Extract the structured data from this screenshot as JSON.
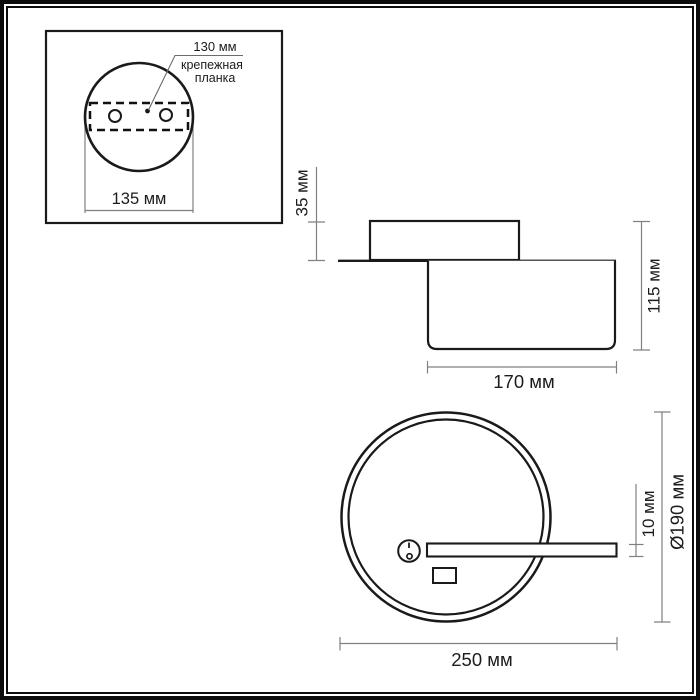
{
  "diagram": {
    "title": "luminaire-dimension-drawing",
    "top_view": {
      "dim_mount_spacing": "130 мм",
      "bracket_label_line1": "крепежная",
      "bracket_label_line2": "планка",
      "dim_base_width": "135 мм"
    },
    "side_view": {
      "dim_canopy_height": "35 мм",
      "dim_total_height": "115 мм",
      "dim_body_width": "170 мм"
    },
    "front_view": {
      "dim_bar_height": "10 мм",
      "dim_ring_diameter": "Ø190 мм",
      "dim_total_width": "250 мм"
    },
    "colors": {
      "outline": "#1a1a1a",
      "dimension_line": "#808080",
      "background": "#ffffff",
      "frame": "#0d0d0d"
    }
  }
}
